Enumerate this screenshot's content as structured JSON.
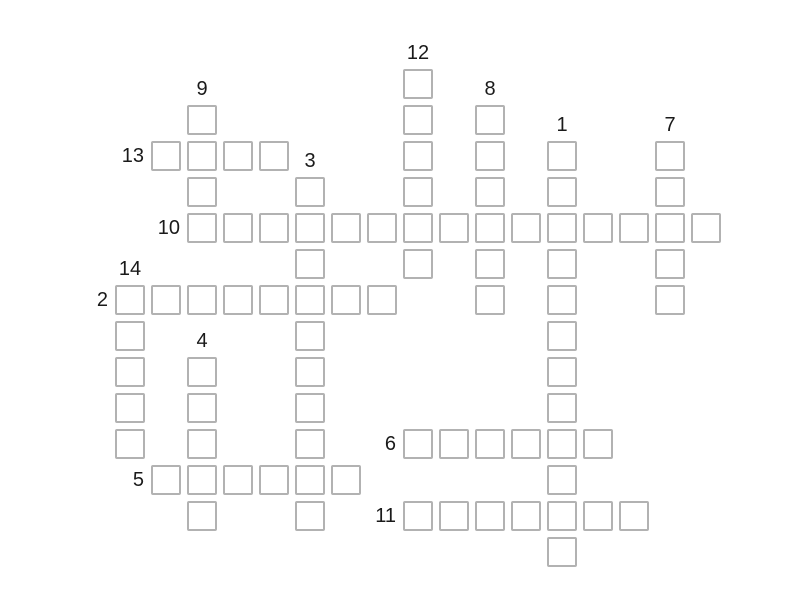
{
  "page": {
    "background_color": "#ffffff"
  },
  "puzzle": {
    "type": "crossword-grid",
    "cell_fill_color": "#ffffff",
    "cell_border_color": "#b2b2b2",
    "label_color": "#1a1a1a",
    "grid": {
      "columns": 17,
      "rows": 14
    },
    "words": [
      {
        "number": "1",
        "direction": "down",
        "row": 2,
        "col": 12,
        "length": 12
      },
      {
        "number": "2",
        "direction": "across",
        "row": 6,
        "col": 0,
        "length": 8
      },
      {
        "number": "3",
        "direction": "down",
        "row": 3,
        "col": 5,
        "length": 10
      },
      {
        "number": "4",
        "direction": "down",
        "row": 8,
        "col": 2,
        "length": 5
      },
      {
        "number": "5",
        "direction": "across",
        "row": 11,
        "col": 1,
        "length": 6
      },
      {
        "number": "6",
        "direction": "across",
        "row": 10,
        "col": 8,
        "length": 6
      },
      {
        "number": "7",
        "direction": "down",
        "row": 2,
        "col": 15,
        "length": 5
      },
      {
        "number": "8",
        "direction": "down",
        "row": 1,
        "col": 10,
        "length": 6
      },
      {
        "number": "9",
        "direction": "down",
        "row": 1,
        "col": 2,
        "length": 4
      },
      {
        "number": "10",
        "direction": "across",
        "row": 4,
        "col": 2,
        "length": 15
      },
      {
        "number": "11",
        "direction": "across",
        "row": 12,
        "col": 8,
        "length": 7
      },
      {
        "number": "12",
        "direction": "down",
        "row": 0,
        "col": 8,
        "length": 6
      },
      {
        "number": "13",
        "direction": "across",
        "row": 2,
        "col": 1,
        "length": 4
      },
      {
        "number": "14",
        "direction": "down",
        "row": 6,
        "col": 0,
        "length": 5
      }
    ]
  }
}
